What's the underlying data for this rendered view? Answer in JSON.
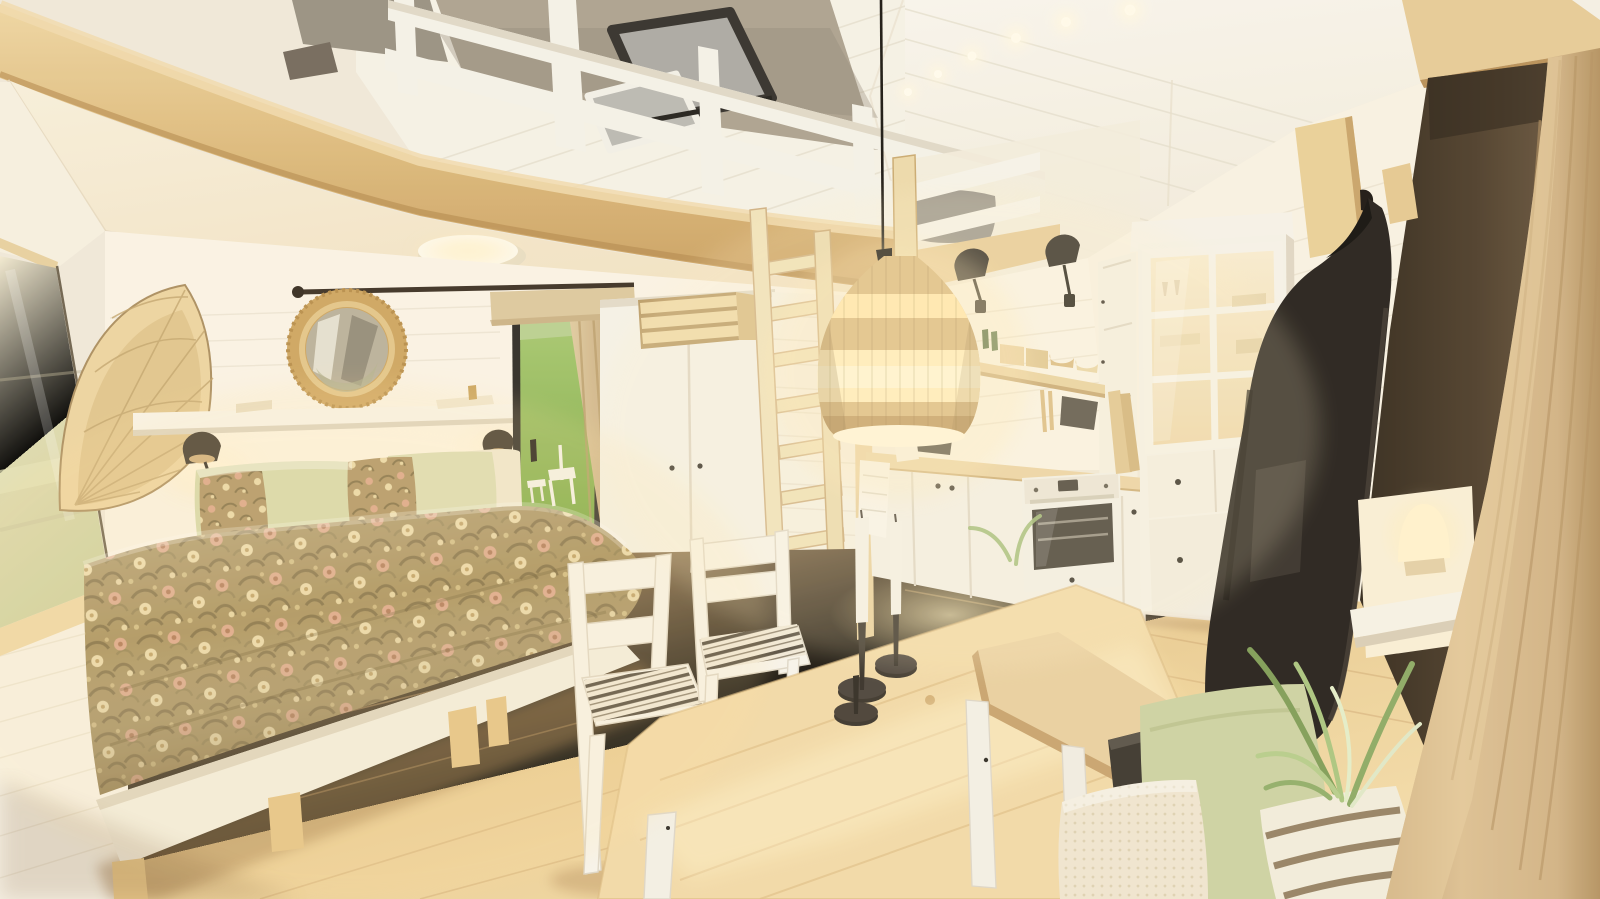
{
  "meta": {
    "title": "Tiny house studio interior — 3D architectural render",
    "description": "Photorealistic render of a scandinavian tiny-house studio: sleeping loft with white guardrail and opened roof window above, floral-duvet double bed with sage pillows, round rattan mirror and wall shelf with black reading sconces, glass door to a green lawn with beige curtain, white wardrobe with wooden ladder to the loft, pine dining table with white chairs and black candlesticks, white kitchenette with built-in oven and lit glass display hutch, rattan pendant lamp on a long black cord, coat rack with black coat, wooden bench with sage and striped cushions, spider plant and a glowing table lamp beside a tan linen curtain."
  },
  "palette": {
    "ceilingWhite": "#f6f2e9",
    "ceilingLine": "#e4ddcd",
    "underLoft": "#f4e9d3",
    "underLoftWarm": "#f1e0c2",
    "beamLight": "#eed5a2",
    "beamMid": "#d9b678",
    "beamDark": "#bf9457",
    "wallWarm": "#faf3e6",
    "wallShadow": "#efe5d2",
    "plankLine": "#e2d8c4",
    "floorLight": "#f5e0af",
    "floorMid": "#e3c28d",
    "floorDark": "#c69c67",
    "windowGlass": "#e0ddb6",
    "lawnGreen": "#82ae47",
    "lawnLight": "#a6ca6e",
    "skyPale": "#e3e8d8",
    "frameBlack": "#2c2824",
    "curtainBeige": "#d6c096",
    "valanceBeige": "#dcc79e",
    "rodBrown": "#3a2e22",
    "duvetBase": "#a18a58",
    "duvetShadow": "#6e5a34",
    "floralCream": "#e9d8a8",
    "floralPink": "#d9a287",
    "floralOlive": "#79663e",
    "sageGreen": "#d5d8ab",
    "creamPillow": "#efe8d2",
    "whitePaint": "#f6f2ea",
    "woodBlond": "#ead7a6",
    "rattan": "#dcbc83",
    "rattanGlow": "#ffe8b0",
    "lampGlow": "#fff3d2",
    "sconceBlack": "#332c25",
    "ovenGlass": "#38332d",
    "hutchGlow": "#f5e4c0",
    "coatBlack": "#221d19",
    "espresso": "#3f3225",
    "tanCurtain": "#d3b184",
    "benchWood": "#e9cfa0",
    "stripeDark": "#4f473c",
    "plantGreen": "#7d9b55",
    "plantLight": "#b5cc8a",
    "grayPanel": "#968e81",
    "taupePanel": "#aaa08f",
    "candleWhite": "#f4f1e8",
    "holderDark": "#3a332b",
    "mirrorGlass": "#b9b09a",
    "mirrorRing": "#cda45f",
    "ovenWhite": "#f2efe8"
  },
  "scene": {
    "setting": "single open room, vaulted white plank ceiling, warm evening lighting",
    "areas": {
      "loft": {
        "objects": [
          "wood fascia beam",
          "white guardrail with posts",
          "opened roof window with dark frame",
          "grey roller panels",
          "grey loft pillows",
          "corner post",
          "loft ladder"
        ]
      },
      "sleeping": {
        "objects": [
          "double bed with white frame and wood block legs",
          "William Morris style floral duvet",
          "two sage green pillows",
          "two floral accent pillows",
          "cream pillow",
          "white floating shelf with book and tray",
          "two black dome reading sconces",
          "round rattan framed mirror",
          "rattan fan wall light",
          "side window with pale reflection",
          "flush round ceiling light"
        ]
      },
      "door_wall": {
        "objects": [
          "black framed glass door",
          "green lawn with white patio chair and table outside",
          "beige curtain with leather strap",
          "beige valance",
          "dark curtain rod with ball finial",
          "white wardrobe with two doors",
          "slatted wood crate on wardrobe",
          "white planked partition wall"
        ]
      },
      "dining": {
        "objects": [
          "pine dining table with white legs",
          "two white chairs with striped ticking cushions",
          "two white taper candles in black candlesticks",
          "extra black candle holder"
        ]
      },
      "kitchen": {
        "objects": [
          "white base cabinets with wood worktop",
          "built-in white oven with dark glass",
          "black induction hob",
          "white waffle towel",
          "open wood shelf with boxes, bowls and green bottles",
          "hanging wooden utensils and dark pot holder",
          "leaning cutting boards",
          "lit glass-front display hutch with drawers and black knobs",
          "two black wall sconces",
          "narrow inner door"
        ]
      },
      "entry": {
        "objects": [
          "white planked wall",
          "wood coat rack boards with peg",
          "black hanging coat",
          "dark espresso wall panel",
          "wood header beam",
          "glowing table lamp on white sill",
          "spider plant",
          "wood bench with white legs",
          "cream boucle pillow",
          "sage pillow",
          "striped pillow",
          "dark leaning board",
          "tan linen curtain"
        ]
      },
      "lighting": {
        "objects": [
          "rattan pendant lamp on long black cord",
          "recessed ceiling spotlights",
          "warm floor light pool"
        ]
      }
    }
  }
}
